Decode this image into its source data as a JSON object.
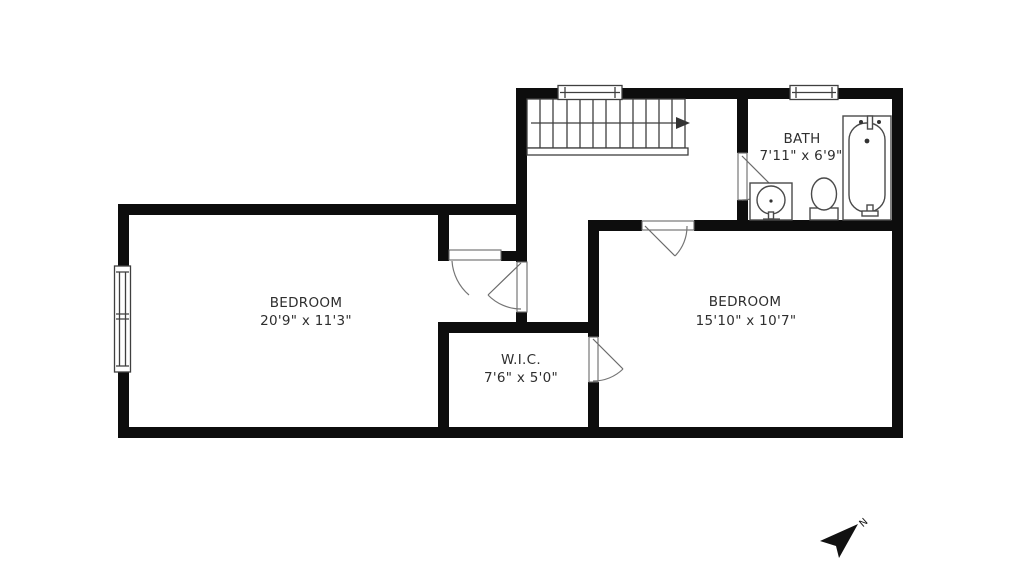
{
  "floor_plan": {
    "rooms": {
      "bedroom_left": {
        "label": "BEDROOM",
        "dimensions": "20'9\" x 11'3\""
      },
      "bedroom_right": {
        "label": "BEDROOM",
        "dimensions": "15'10\" x 10'7\""
      },
      "closet": {
        "label": "W.I.C.",
        "dimensions": "7'6\" x 5'0\""
      },
      "bathroom": {
        "label": "BATH",
        "dimensions": "7'11\" x 6'9\""
      }
    },
    "compass": {
      "north_label": "N"
    },
    "fixtures": [
      "staircase",
      "stair-direction-arrow",
      "bathtub",
      "toilet",
      "sink-vanity",
      "window-double-left",
      "window-top-stairs",
      "window-top-bath",
      "door-swings"
    ],
    "colors": {
      "wall": "#0d0d0d",
      "background": "#ffffff",
      "fixture_line": "#4a4a4a",
      "door_arc": "#757575",
      "text": "#2e2e2e"
    }
  }
}
